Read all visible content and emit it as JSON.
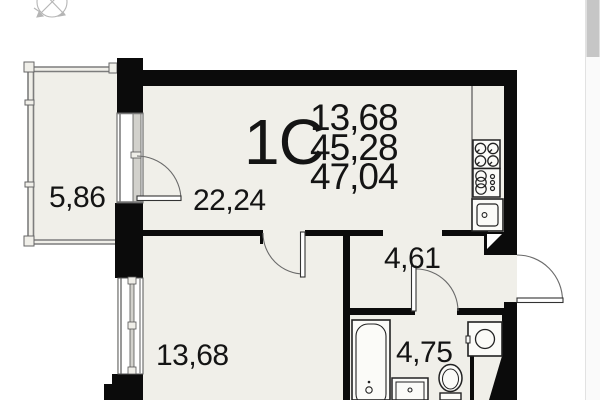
{
  "plan": {
    "apartment_type_label": "1С",
    "area_summary": [
      "13,68",
      "45,28",
      "47,04"
    ],
    "rooms": {
      "balcony": {
        "area": "5,86"
      },
      "living": {
        "area": "22,24"
      },
      "bedroom": {
        "area": "13,68"
      },
      "hallway": {
        "area": "4,61"
      },
      "bathroom": {
        "area": "4,75"
      }
    },
    "icons": {
      "compass": "compass-rose",
      "stove": "4-burner-stove",
      "oven": "oven-coils",
      "kitchen_sink": "square-sink-with-drain",
      "bathtub": "bathtub",
      "washbasin": "square-basin",
      "toilet": "toilet",
      "washing_machine": "square-with-circle",
      "vent": "vent-shaft-triangle"
    }
  },
  "colors": {
    "wall": "#0b0b0b",
    "room_fill": "#f0efe9",
    "fixture_fill": "#fbfbf8",
    "thin_line": "#3f3f3f",
    "glazing": "#7d7d7d",
    "compass": "#b5b5b5",
    "scrollbar_track": "#fafafa",
    "scrollbar_thumb": "#c6c6c6"
  },
  "scrollbar": {
    "thumb_top": 0,
    "thumb_height": 57
  }
}
